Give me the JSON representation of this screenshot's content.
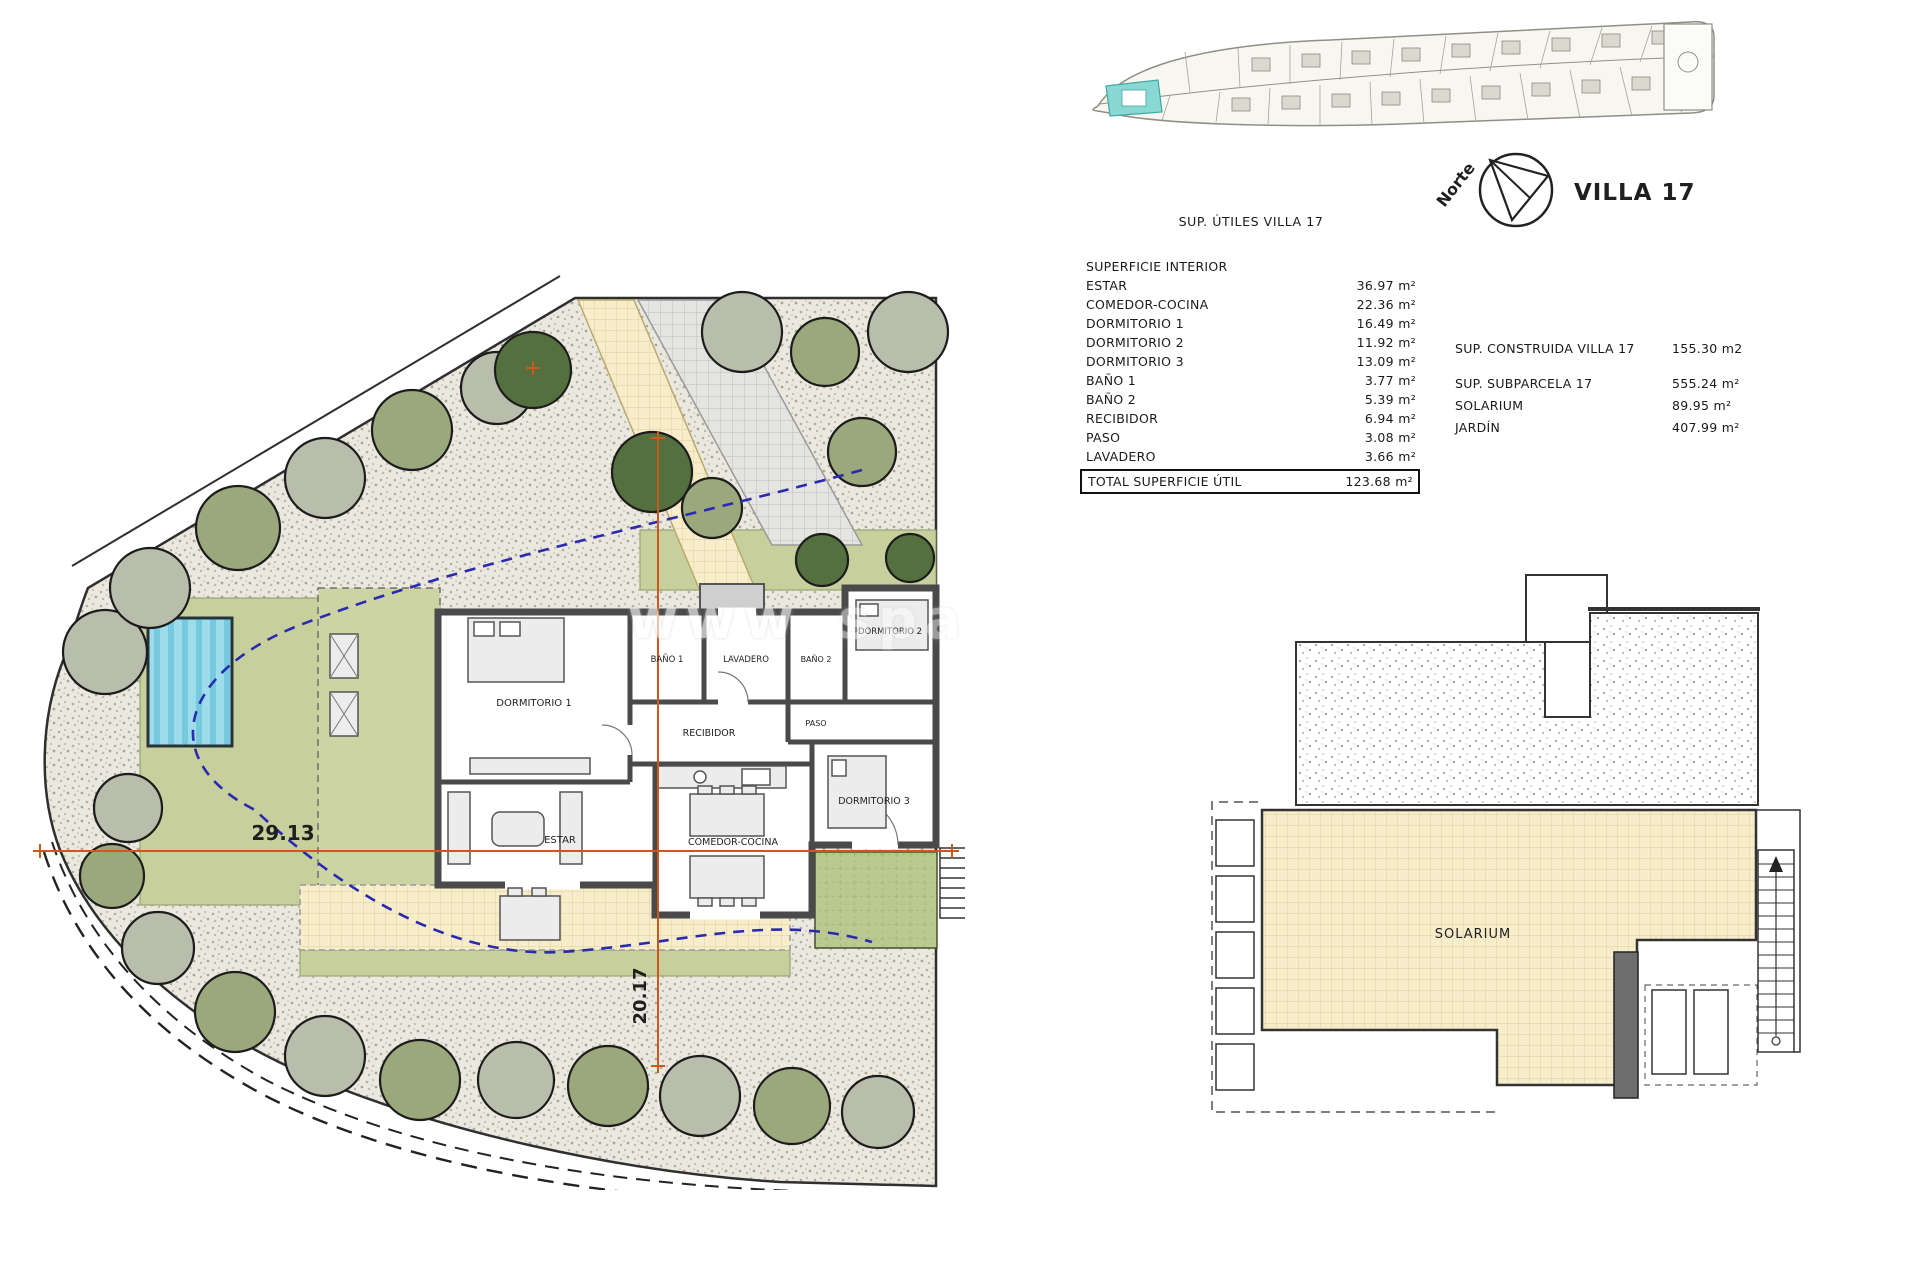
{
  "key_plan": {
    "north_label": "Norte",
    "villa_label": "VILLA 17"
  },
  "site_plan": {
    "dim_horizontal": "29.13",
    "dim_vertical": "20.17",
    "watermark_left": "www",
    "watermark_right": "spa",
    "rooms": {
      "dormitorio1": "DORMITORIO 1",
      "bano1": "BAÑO 1",
      "lavadero": "LAVADERO",
      "recibidor": "RECIBIDOR",
      "paso": "PASO",
      "bano2": "BAÑO 2",
      "dormitorio2": "DORMITORIO 2",
      "dormitorio3": "DORMITORIO 3",
      "estar": "ESTAR",
      "comedor": "COMEDOR-COCINA"
    }
  },
  "areas_table": {
    "title": "SUP. ÚTILES VILLA 17",
    "section_header": "SUPERFICIE INTERIOR",
    "rows": [
      {
        "label": "ESTAR",
        "value": "36.97 m²"
      },
      {
        "label": "COMEDOR-COCINA",
        "value": "22.36 m²"
      },
      {
        "label": "DORMITORIO 1",
        "value": "16.49 m²"
      },
      {
        "label": "DORMITORIO 2",
        "value": "11.92 m²"
      },
      {
        "label": "DORMITORIO 3",
        "value": "13.09 m²"
      },
      {
        "label": "BAÑO 1",
        "value": "3.77 m²"
      },
      {
        "label": "BAÑO 2",
        "value": "5.39 m²"
      },
      {
        "label": "RECIBIDOR",
        "value": "6.94 m²"
      },
      {
        "label": "PASO",
        "value": "3.08 m²"
      },
      {
        "label": "LAVADERO",
        "value": "3.66 m²"
      }
    ],
    "total": {
      "label": "TOTAL SUPERFICIE ÚTIL",
      "value": "123.68 m²"
    }
  },
  "summary": {
    "rows": [
      {
        "label": "SUP. CONSTRUIDA VILLA 17",
        "value": "155.30 m2"
      },
      {
        "label": "SUP. SUBPARCELA 17",
        "value": "555.24 m²"
      },
      {
        "label": "SOLARIUM",
        "value": "89.95 m²"
      },
      {
        "label": "JARDÍN",
        "value": "407.99 m²"
      }
    ]
  },
  "solarium_plan": {
    "label": "SOLARIUM"
  },
  "colors": {
    "dimension_orange": "#c95a1e",
    "setback_blue": "#2a2ab0",
    "pool_water": "#9ddcea",
    "plot_highlight_cyan": "#8ad8d4",
    "garden_green": "#c7d09c",
    "terrace_yellow": "#f7edca",
    "gravel": "#eae8df"
  }
}
